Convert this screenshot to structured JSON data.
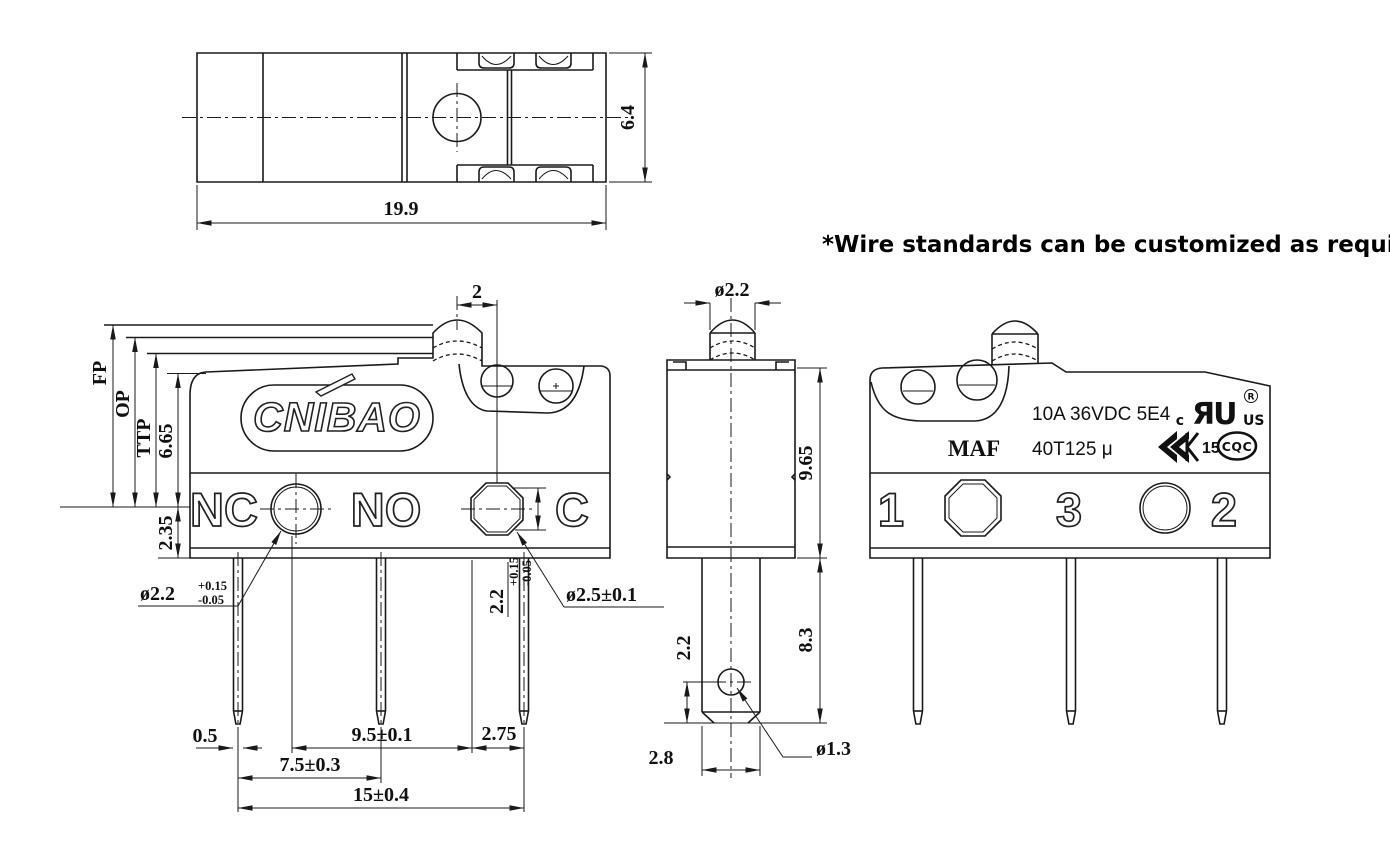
{
  "note": {
    "text": "*Wire standards can be customized as required"
  },
  "top_view": {
    "length": "19.9",
    "width": "6.4"
  },
  "front_view": {
    "logo": "CNIBAO",
    "labels": {
      "nc": "NC",
      "no": "NO",
      "c": "C"
    },
    "dims": {
      "fp": "FP",
      "op": "OP",
      "ttp": "TTP",
      "height_body": "6.65",
      "height_base": "2.35",
      "plunger_offset": "2",
      "nc_hole_dia": "ø2.2",
      "nc_hole_tol_plus": "+0.15",
      "nc_hole_tol_minus": "-0.05",
      "c_hole_height": "2.2",
      "c_hole_tol_plus": "+0.15",
      "c_hole_tol_minus": "-0.05",
      "c_hole_dia": "ø2.5±0.1",
      "pin_width": "0.5",
      "hole_pitch": "9.5±0.1",
      "hole_to_pin": "2.75",
      "pin_pitch_near": "7.5±0.3",
      "pin_pitch_far": "15±0.4"
    }
  },
  "end_view": {
    "dims": {
      "plunger_dia": "ø2.2",
      "body_height": "9.65",
      "terminal_length": "8.3",
      "hole_offset": "2.2",
      "hole_dia": "ø1.3",
      "terminal_width": "2.8"
    }
  },
  "back_view": {
    "model": "MAF",
    "rating_line1": "10A 36VDC 5E4",
    "rating_line2": "40T125 μ",
    "marks": {
      "ul_c": "c",
      "ul_glyph": "ЯU",
      "ul_us": "US",
      "ul_r": "R",
      "enec_number": "15",
      "cqc": "CQC"
    },
    "terminals": {
      "t1": "1",
      "t3": "3",
      "t2": "2"
    }
  }
}
